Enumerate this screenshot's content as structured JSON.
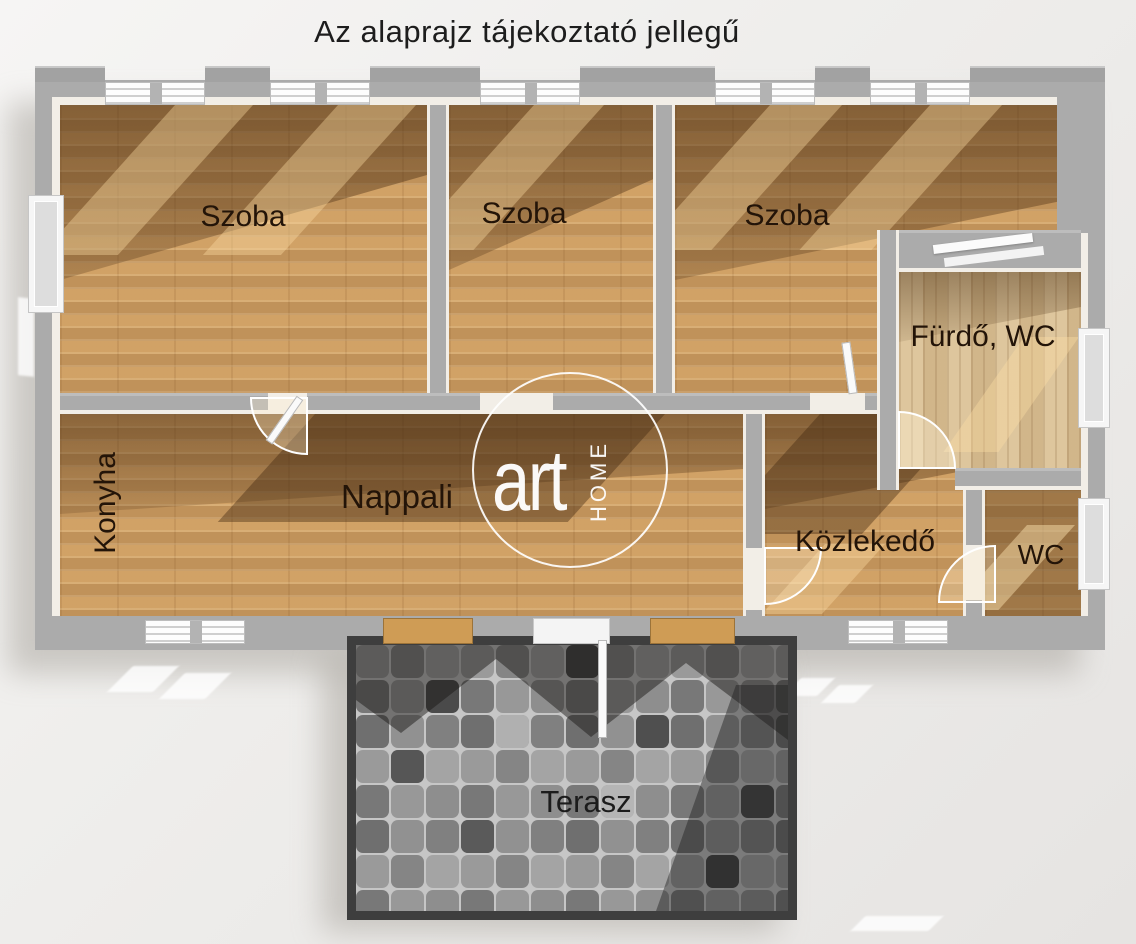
{
  "title": "Az alaprajz tájekoztató jellegű",
  "watermark": {
    "brand_main": "art",
    "brand_sub": "HOME"
  },
  "rooms": [
    {
      "id": "szoba-1",
      "label": "Szoba"
    },
    {
      "id": "szoba-2",
      "label": "Szoba"
    },
    {
      "id": "szoba-3",
      "label": "Szoba"
    },
    {
      "id": "furdo-wc",
      "label": "Fürdő, WC"
    },
    {
      "id": "konyha",
      "label": "Konyha"
    },
    {
      "id": "nappali",
      "label": "Nappali"
    },
    {
      "id": "kozlekedo",
      "label": "Közlekedő"
    },
    {
      "id": "wc",
      "label": "WC"
    },
    {
      "id": "terasz",
      "label": "Terasz"
    }
  ],
  "colors": {
    "background": "#efedeb",
    "wall_gray": "#ababab",
    "wall_inner_face": "#f2eee7",
    "wood_floor": "#cfa065",
    "wood_pale": "#d8bf94",
    "terrace_frame": "#3e3e3e",
    "tile_gap": "#c6c6c6",
    "tile_dark": "#4a4a4a",
    "label_text": "#231408",
    "title_text": "#1d1d1d",
    "watermark": "#ffffff"
  }
}
